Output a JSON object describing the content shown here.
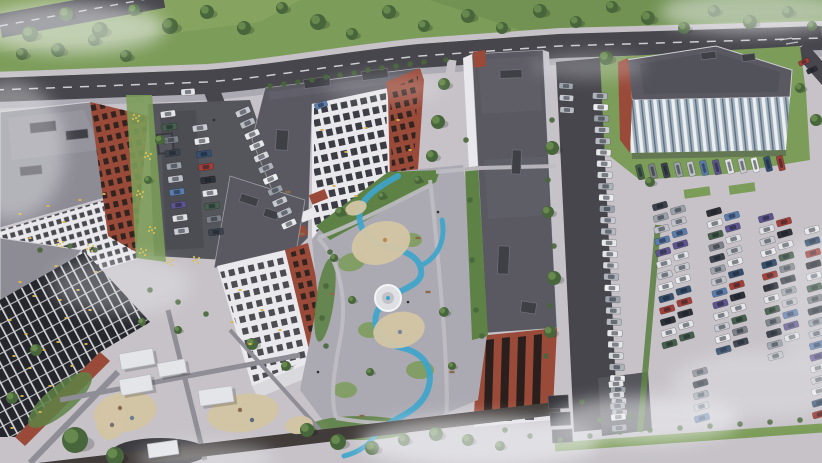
{
  "meta": {
    "description": "Aerial 3D render of a residential complex: angular apartment blocks with gray roofs and brick accents, landscaped courtyard with winding blue path, playgrounds with canopies, tree-lined road and large car parks"
  },
  "palette": {
    "grass": "#7c9c59",
    "grass-dark": "#5e8246",
    "grass-light": "#93ae68",
    "tree": "#48663b",
    "tree-light": "#6f9252",
    "asphalt": "#46464c",
    "asphalt-light": "#55555c",
    "road-line": "#dcdce0",
    "pavement": "#c6c2c8",
    "pavement-dark": "#abaab2",
    "path": "#8f8d95",
    "roof": "#5a5962",
    "roof-light": "#8d8c95",
    "roof-edge": "#cfcfd5",
    "facade": "#e9e8ec",
    "window": "#24262c",
    "window-lit": "#d8b44a",
    "brick": "#9a4a39",
    "brick-dark": "#6e352a",
    "water": "#3da5cd",
    "sand": "#d3c5a4",
    "canopy": "#e3e5e9",
    "fog": "#f2f3f6",
    "glass-stripe": "#9fb0bf"
  },
  "scene": {
    "car_colors": {
      "light": [
        "#e4e5e8",
        "#c8cbd1",
        "#aeb3ba",
        "#e7e8ea",
        "#9aa1a9",
        "#d6d8dc",
        "#b6bac1",
        "#edeef0"
      ],
      "mixed": [
        "#e4e5e8",
        "#3d434c",
        "#5b7dad",
        "#c8cbd1",
        "#a23f38",
        "#46604d",
        "#9aa1a9",
        "#5e548f",
        "#e9eaec",
        "#2e3138",
        "#7d8188",
        "#bfc3c9",
        "#dfe1e4",
        "#35506e"
      ]
    },
    "car_rows": [
      {
        "name": "left-lot-col-1",
        "x": 168,
        "y": 114,
        "dx": 1.5,
        "dy": 13,
        "count": 10,
        "w": 15,
        "h": 6.5,
        "angle": -8,
        "scheme": "mixed",
        "seed": 0
      },
      {
        "name": "left-lot-col-2",
        "x": 200,
        "y": 128,
        "dx": 2,
        "dy": 13,
        "count": 9,
        "w": 15,
        "h": 6.5,
        "angle": -8,
        "scheme": "mixed",
        "seed": 3
      },
      {
        "name": "left-lot-diagonal",
        "x": 243,
        "y": 112,
        "dx": 4.6,
        "dy": 11.2,
        "count": 11,
        "w": 15,
        "h": 6.5,
        "angle": -24,
        "scheme": "light",
        "seed": 1
      },
      {
        "name": "street-strip-column",
        "x": 600,
        "y": 96,
        "dx": 0.7,
        "dy": 11.3,
        "count": 29,
        "w": 15,
        "h": 6.5,
        "angle": 2,
        "scheme": "light",
        "seed": 2
      },
      {
        "name": "street-strip-top",
        "x": 566,
        "y": 86,
        "dx": 0.5,
        "dy": 12,
        "count": 3,
        "w": 14,
        "h": 6,
        "angle": 4,
        "scheme": "light",
        "seed": 4
      },
      {
        "name": "office-row",
        "x": 640,
        "y": 172,
        "dx": 12.8,
        "dy": -0.8,
        "count": 12,
        "w": 6.5,
        "h": 15,
        "angle": -14,
        "scheme": "mixed",
        "seed": 5
      },
      {
        "name": "lot-col-a1",
        "x": 660,
        "y": 206,
        "dx": 0.8,
        "dy": 11.5,
        "count": 13,
        "w": 15,
        "h": 6.5,
        "angle": -16,
        "scheme": "mixed",
        "seed": 1
      },
      {
        "name": "lot-col-a2",
        "x": 678,
        "y": 210,
        "dx": 0.8,
        "dy": 11.5,
        "count": 12,
        "w": 15,
        "h": 6.5,
        "angle": -16,
        "scheme": "mixed",
        "seed": 6
      },
      {
        "name": "lot-col-b1",
        "x": 714,
        "y": 212,
        "dx": 0.8,
        "dy": 11.5,
        "count": 13,
        "w": 15,
        "h": 6.5,
        "angle": -16,
        "scheme": "mixed",
        "seed": 9
      },
      {
        "name": "lot-col-b2",
        "x": 732,
        "y": 216,
        "dx": 0.8,
        "dy": 11.5,
        "count": 12,
        "w": 15,
        "h": 6.5,
        "angle": -16,
        "scheme": "mixed",
        "seed": 2
      },
      {
        "name": "lot-col-c1",
        "x": 766,
        "y": 218,
        "dx": 0.8,
        "dy": 11.5,
        "count": 13,
        "w": 15,
        "h": 6.5,
        "angle": -16,
        "scheme": "mixed",
        "seed": 7
      },
      {
        "name": "lot-col-c2",
        "x": 784,
        "y": 222,
        "dx": 0.8,
        "dy": 11.5,
        "count": 11,
        "w": 15,
        "h": 6.5,
        "angle": -16,
        "scheme": "mixed",
        "seed": 4
      },
      {
        "name": "lot-col-edge",
        "x": 812,
        "y": 230,
        "dx": 0.5,
        "dy": 11.5,
        "count": 17,
        "w": 15,
        "h": 6.5,
        "angle": -16,
        "scheme": "mixed",
        "seed": 8
      },
      {
        "name": "lot-lower",
        "x": 700,
        "y": 372,
        "dx": 0.5,
        "dy": 11.5,
        "count": 5,
        "w": 15,
        "h": 6.5,
        "angle": -16,
        "scheme": "mixed",
        "seed": 10
      },
      {
        "name": "bottom-lane-column",
        "x": 616,
        "y": 384,
        "dx": 0.8,
        "dy": 11,
        "count": 5,
        "w": 15,
        "h": 6.5,
        "angle": -6,
        "scheme": "light",
        "seed": 0
      },
      {
        "name": "side-road-cars",
        "x": 804,
        "y": 62,
        "dx": 8,
        "dy": 8,
        "count": 2,
        "w": 11,
        "h": 5,
        "angle": -24,
        "scheme": "mixed",
        "seed": 4
      },
      {
        "name": "moving-car",
        "x": 188,
        "y": 92,
        "dx": 0,
        "dy": 0,
        "count": 1,
        "w": 14,
        "h": 6.5,
        "angle": -4,
        "scheme": "light",
        "seed": 0
      },
      {
        "name": "entrance-car",
        "x": 321,
        "y": 105,
        "dx": 0,
        "dy": 0,
        "count": 1,
        "w": 13,
        "h": 6,
        "angle": -20,
        "scheme": "mixed",
        "seed": 2
      }
    ],
    "trees_park": [
      [
        30,
        34,
        8
      ],
      [
        66,
        14,
        7
      ],
      [
        100,
        30,
        8
      ],
      [
        134,
        10,
        6
      ],
      [
        170,
        26,
        8
      ],
      [
        207,
        12,
        7
      ],
      [
        244,
        28,
        7
      ],
      [
        282,
        8,
        6
      ],
      [
        318,
        22,
        8
      ],
      [
        352,
        34,
        6
      ],
      [
        389,
        12,
        7
      ],
      [
        424,
        26,
        6
      ],
      [
        468,
        16,
        7
      ],
      [
        502,
        28,
        6
      ],
      [
        540,
        11,
        7
      ],
      [
        576,
        22,
        6
      ],
      [
        612,
        7,
        6
      ],
      [
        648,
        18,
        7
      ],
      [
        684,
        28,
        6
      ],
      [
        714,
        11,
        6
      ],
      [
        750,
        22,
        7
      ],
      [
        788,
        12,
        6
      ],
      [
        812,
        26,
        5
      ],
      [
        22,
        54,
        6
      ],
      [
        58,
        50,
        7
      ],
      [
        94,
        40,
        6
      ],
      [
        126,
        56,
        6
      ]
    ],
    "trees_ground": [
      [
        444,
        84,
        6
      ],
      [
        438,
        122,
        7
      ],
      [
        432,
        156,
        6
      ],
      [
        552,
        148,
        7
      ],
      [
        548,
        212,
        6
      ],
      [
        554,
        278,
        7
      ],
      [
        550,
        332,
        6
      ],
      [
        606,
        58,
        7
      ],
      [
        650,
        182,
        5
      ],
      [
        816,
        120,
        6
      ],
      [
        800,
        88,
        5
      ],
      [
        340,
        212,
        5
      ],
      [
        382,
        196,
        4
      ],
      [
        418,
        180,
        4
      ],
      [
        334,
        258,
        4
      ],
      [
        352,
        300,
        4
      ],
      [
        444,
        312,
        5
      ],
      [
        370,
        372,
        4
      ],
      [
        452,
        366,
        4
      ],
      [
        75,
        440,
        13
      ],
      [
        115,
        456,
        9
      ],
      [
        36,
        350,
        6
      ],
      [
        12,
        398,
        6
      ],
      [
        252,
        344,
        6
      ],
      [
        286,
        366,
        5
      ],
      [
        307,
        430,
        7
      ],
      [
        338,
        442,
        8
      ],
      [
        372,
        448,
        7
      ],
      [
        404,
        440,
        6
      ],
      [
        436,
        434,
        7
      ],
      [
        468,
        440,
        6
      ],
      [
        500,
        446,
        5
      ],
      [
        178,
        330,
        4
      ],
      [
        142,
        322,
        4
      ],
      [
        160,
        140,
        5
      ],
      [
        148,
        180,
        4
      ]
    ],
    "bushes": [
      [
        270,
        86
      ],
      [
        284,
        84
      ],
      [
        298,
        82
      ],
      [
        312,
        80
      ],
      [
        326,
        77
      ],
      [
        340,
        75
      ],
      [
        354,
        73
      ],
      [
        368,
        70
      ],
      [
        382,
        68
      ],
      [
        396,
        66
      ],
      [
        410,
        64
      ],
      [
        424,
        62
      ],
      [
        446,
        60
      ],
      [
        466,
        140
      ],
      [
        470,
        200
      ],
      [
        472,
        260
      ],
      [
        476,
        310
      ],
      [
        482,
        336
      ],
      [
        330,
        252
      ],
      [
        326,
        286
      ],
      [
        322,
        318
      ],
      [
        326,
        346
      ],
      [
        150,
        290
      ],
      [
        178,
        302
      ],
      [
        206,
        314
      ],
      [
        552,
        120
      ],
      [
        548,
        180
      ],
      [
        554,
        246
      ],
      [
        550,
        306
      ],
      [
        546,
        356
      ],
      [
        600,
        420
      ],
      [
        630,
        416
      ],
      [
        582,
        402
      ],
      [
        95,
        250
      ],
      [
        70,
        246
      ],
      [
        40,
        250
      ],
      [
        505,
        430
      ],
      [
        530,
        436
      ],
      [
        560,
        440
      ],
      [
        590,
        436
      ],
      [
        620,
        432
      ],
      [
        650,
        430
      ],
      [
        680,
        428
      ],
      [
        710,
        426
      ],
      [
        740,
        424
      ],
      [
        770,
        422
      ],
      [
        800,
        420
      ]
    ],
    "flower_clusters": [
      [
        136,
        118
      ],
      [
        148,
        156
      ],
      [
        140,
        194
      ],
      [
        152,
        230
      ],
      [
        143,
        252
      ],
      [
        196,
        260
      ],
      [
        170,
        262
      ],
      [
        60,
        244
      ],
      [
        90,
        248
      ]
    ],
    "lit_windows": [
      [
        10,
        320
      ],
      [
        26,
        334
      ],
      [
        44,
        350
      ],
      [
        14,
        356
      ],
      [
        58,
        342
      ],
      [
        30,
        368
      ],
      [
        66,
        318
      ],
      [
        50,
        386
      ],
      [
        22,
        396
      ],
      [
        72,
        366
      ],
      [
        40,
        412
      ],
      [
        12,
        428
      ],
      [
        86,
        344
      ],
      [
        90,
        310
      ],
      [
        60,
        300
      ],
      [
        34,
        296
      ],
      [
        78,
        290
      ],
      [
        96,
        272
      ],
      [
        56,
        266
      ],
      [
        20,
        282
      ],
      [
        20,
        214
      ],
      [
        48,
        206
      ],
      [
        80,
        200
      ],
      [
        104,
        194
      ],
      [
        64,
        222
      ],
      [
        30,
        238
      ],
      [
        322,
        130
      ],
      [
        346,
        152
      ],
      [
        334,
        186
      ],
      [
        366,
        128
      ],
      [
        356,
        196
      ],
      [
        398,
        120
      ],
      [
        410,
        150
      ],
      [
        240,
        290
      ],
      [
        262,
        310
      ],
      [
        250,
        344
      ],
      [
        280,
        330
      ],
      [
        232,
        322
      ]
    ],
    "roof_vents": [
      [
        304,
        78,
        26,
        9,
        -7
      ],
      [
        362,
        70,
        26,
        9,
        -7
      ],
      [
        276,
        130,
        12,
        20,
        3
      ],
      [
        500,
        70,
        22,
        8,
        -2
      ],
      [
        512,
        150,
        9,
        24,
        2
      ],
      [
        498,
        246,
        11,
        28,
        2
      ],
      [
        521,
        302,
        15,
        11,
        9
      ],
      [
        30,
        122,
        26,
        10,
        -6
      ],
      [
        66,
        130,
        22,
        9,
        -6
      ],
      [
        20,
        166,
        22,
        9,
        -6
      ],
      [
        701,
        52,
        15,
        7,
        -7
      ],
      [
        742,
        54,
        13,
        7,
        -7
      ],
      [
        240,
        196,
        18,
        8,
        18
      ],
      [
        264,
        210,
        14,
        8,
        18
      ]
    ],
    "garages": [
      [
        548,
        396,
        20,
        13,
        -3
      ],
      [
        550,
        413,
        20,
        13,
        -3
      ],
      [
        552,
        430,
        20,
        13,
        -3
      ]
    ],
    "canopies": [
      [
        137,
        359,
        34,
        16,
        -10
      ],
      [
        172,
        368,
        28,
        14,
        -10
      ],
      [
        136,
        385,
        32,
        16,
        -10
      ],
      [
        216,
        396,
        34,
        16,
        -8
      ],
      [
        163,
        449,
        30,
        14,
        -8
      ]
    ],
    "sand_patches": [
      {
        "x": 125,
        "y": 412,
        "rx": 32,
        "ry": 20,
        "a": -10
      },
      {
        "x": 243,
        "y": 413,
        "rx": 36,
        "ry": 19,
        "a": -8
      },
      {
        "x": 111,
        "y": 419,
        "rx": 15,
        "ry": 21,
        "a": 8
      },
      {
        "x": 381,
        "y": 243,
        "rx": 30,
        "ry": 21,
        "a": -18
      },
      {
        "x": 399,
        "y": 330,
        "rx": 26,
        "ry": 18,
        "a": -12
      },
      {
        "x": 356,
        "y": 208,
        "rx": 11,
        "ry": 7,
        "a": -20
      },
      {
        "x": 299,
        "y": 425,
        "rx": 14,
        "ry": 9,
        "a": -8
      }
    ],
    "play_equipment": [
      [
        120,
        408,
        "#8a6d4f"
      ],
      [
        132,
        418,
        "#6d7f8c"
      ],
      [
        240,
        410,
        "#8a6d4f"
      ],
      [
        252,
        420,
        "#5c6c78"
      ],
      [
        385,
        240,
        "#b98a54"
      ],
      [
        400,
        332,
        "#7a8a96"
      ],
      [
        112,
        425,
        "#76716b"
      ]
    ],
    "benches": [
      [
        288,
        192
      ],
      [
        302,
        234
      ],
      [
        418,
        238
      ],
      [
        332,
        294
      ],
      [
        428,
        292
      ],
      [
        362,
        416
      ],
      [
        452,
        372
      ]
    ],
    "figures": [
      [
        103,
        333
      ],
      [
        318,
        372
      ],
      [
        438,
        212
      ],
      [
        408,
        302
      ],
      [
        214,
        120
      ]
    ],
    "fog_wisps": [
      {
        "x": 70,
        "y": 28,
        "rx": 95,
        "ry": 26,
        "o": 0.55
      },
      {
        "x": 10,
        "y": 150,
        "rx": 55,
        "ry": 70,
        "o": 0.38
      },
      {
        "x": 120,
        "y": 285,
        "rx": 70,
        "ry": 30,
        "o": 0.3
      },
      {
        "x": 755,
        "y": 12,
        "rx": 95,
        "ry": 22,
        "o": 0.5
      },
      {
        "x": 590,
        "y": 66,
        "rx": 55,
        "ry": 13,
        "o": 0.28
      },
      {
        "x": 480,
        "y": 442,
        "rx": 120,
        "ry": 26,
        "o": 0.6
      },
      {
        "x": 645,
        "y": 420,
        "rx": 95,
        "ry": 24,
        "o": 0.55
      },
      {
        "x": 760,
        "y": 385,
        "rx": 90,
        "ry": 34,
        "o": 0.32
      },
      {
        "x": 818,
        "y": 300,
        "rx": 45,
        "ry": 65,
        "o": 0.28
      },
      {
        "x": 205,
        "y": 458,
        "rx": 70,
        "ry": 15,
        "o": 0.4
      },
      {
        "x": 385,
        "y": 88,
        "rx": 60,
        "ry": 14,
        "o": 0.22
      }
    ]
  }
}
